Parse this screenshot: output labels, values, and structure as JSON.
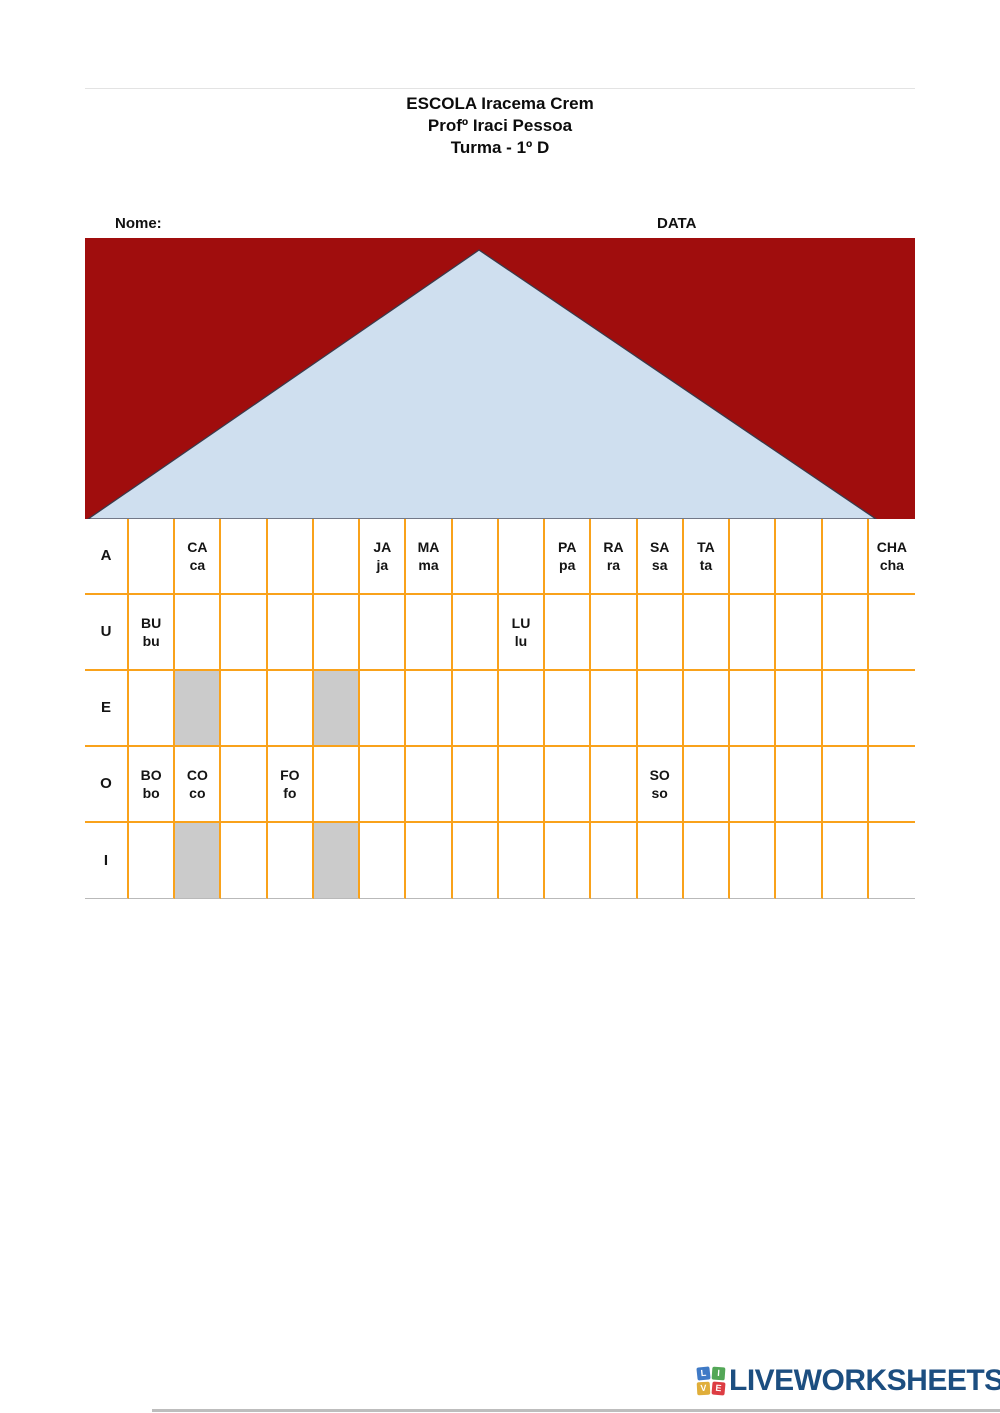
{
  "header": {
    "lines": [
      "ESCOLA Iracema Crem",
      "Profº Iraci Pessoa",
      "Turma - 1º D"
    ]
  },
  "fields": {
    "name_label": "Nome:",
    "date_label": "DATA"
  },
  "banner": {
    "shape_name": "roof-triangle"
  },
  "colors": {
    "banner_red": "#A00D0D",
    "triangle_blue": "#CFDFEF",
    "triangle_outline": "#3A3A4A",
    "grid_orange": "#F9A21B",
    "cell_gray": "#CBCBCB",
    "logo_blue": "#1C4E80",
    "table_bottom_gray": "#B9B9B9"
  },
  "table": {
    "row_labels": [
      "A",
      "U",
      "E",
      "O",
      "I"
    ],
    "num_columns": 17,
    "rows": [
      {
        "label": "A",
        "cells": {
          "2": [
            "CA",
            "ca"
          ],
          "6": [
            "JA",
            "ja"
          ],
          "7": [
            "MA",
            "ma"
          ],
          "10": [
            "PA",
            "pa"
          ],
          "11": [
            "RA",
            "ra"
          ],
          "12": [
            "SA",
            "sa"
          ],
          "13": [
            "TA",
            "ta"
          ],
          "17": [
            "CHA",
            "cha"
          ]
        },
        "gray": []
      },
      {
        "label": "U",
        "cells": {
          "1": [
            "BU",
            "bu"
          ],
          "9": [
            "LU",
            "lu"
          ]
        },
        "gray": []
      },
      {
        "label": "E",
        "cells": {},
        "gray": [
          2,
          5
        ]
      },
      {
        "label": "O",
        "cells": {
          "1": [
            "BO",
            "bo"
          ],
          "2": [
            "CO",
            "co"
          ],
          "4": [
            "FO",
            "fo"
          ],
          "12": [
            "SO",
            "so"
          ]
        },
        "gray": []
      },
      {
        "label": "I",
        "cells": {},
        "gray": [
          2,
          5
        ]
      }
    ]
  },
  "footer": {
    "logo_text": "LIVEWORKSHEETS",
    "logo_squares": [
      {
        "letter": "L",
        "color": "#3F7AC6"
      },
      {
        "letter": "I",
        "color": "#53A757"
      },
      {
        "letter": "V",
        "color": "#E0AE3A"
      },
      {
        "letter": "E",
        "color": "#DD3D43"
      }
    ]
  }
}
